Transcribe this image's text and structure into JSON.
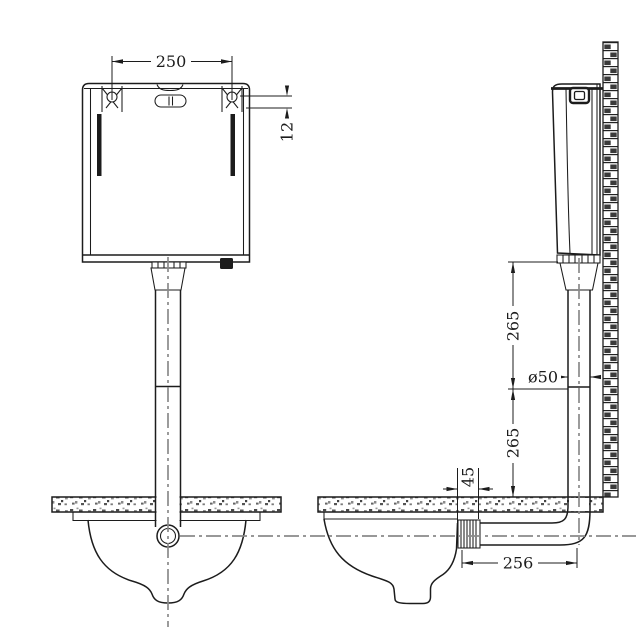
{
  "drawing": {
    "background": "#ffffff",
    "line_color": "#1c1c1c",
    "centerline_color": "#8a8a8a",
    "views": {
      "front": {
        "name": "Cistern front view with flush pipe and squat pan",
        "dims": {
          "mounting_hole_spacing": "250",
          "mounting_hole_drop": "12"
        }
      },
      "side": {
        "name": "Cistern side view on wall with flush pipe, floor and pan",
        "dims": {
          "pipe_upper_segment": "265",
          "pipe_diameter": "ø50",
          "pipe_lower_segment": "265",
          "inlet_socket_depth": "45",
          "inlet_to_pipe_offset": "256"
        }
      }
    }
  }
}
